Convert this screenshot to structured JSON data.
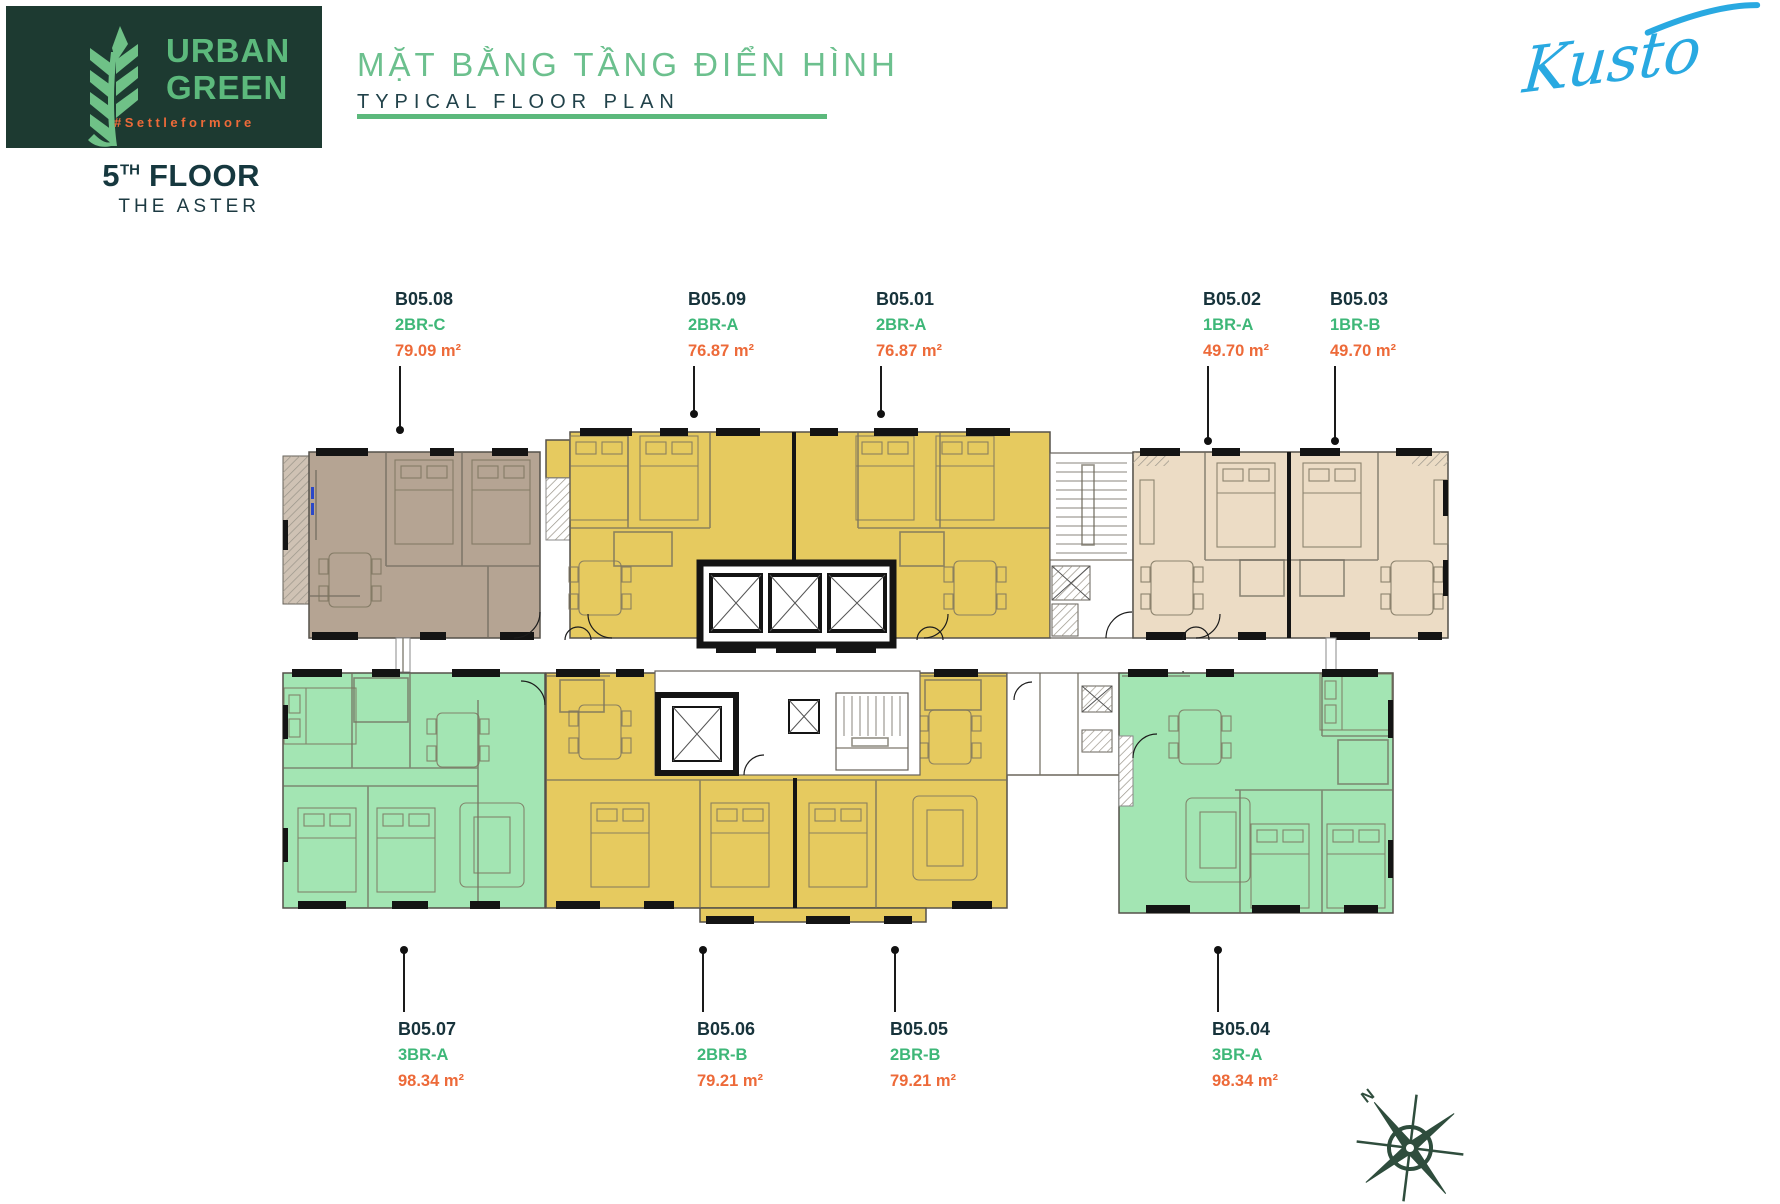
{
  "header": {
    "logo": {
      "line1": "URBAN",
      "line2": "GREEN",
      "hashtag": "#Settleformore"
    },
    "title": {
      "vi": "MẶT BẰNG TẦNG ĐIỂN HÌNH",
      "en": "TYPICAL FLOOR PLAN"
    },
    "brand": "Kusto",
    "floor": {
      "number": "5",
      "ordinal": "TH",
      "word": "FLOOR",
      "building": "THE ASTER"
    }
  },
  "compass": {
    "north_label": "N"
  },
  "colors": {
    "brand_dark": "#1d3a31",
    "brand_green": "#5cb97c",
    "title_green": "#6cc08e",
    "navy": "#17333b",
    "type_green": "#3eb778",
    "orange": "#ed6a39",
    "kusto_blue": "#29a9e1",
    "unit_yellow": "#e6ca5f",
    "unit_green": "#a3e5b3",
    "unit_beige": "#ecdcc5",
    "unit_taupe": "#b5a493",
    "wall_black": "#141414"
  },
  "units": [
    {
      "id": "B05.08",
      "type": "2BR-C",
      "area": "79.09 m²",
      "label_x": 395,
      "label_y": 286,
      "line_x": 399,
      "line_y1": 366,
      "line_y2": 430,
      "dot_y": 430
    },
    {
      "id": "B05.09",
      "type": "2BR-A",
      "area": "76.87 m²",
      "label_x": 688,
      "label_y": 286,
      "line_x": 693,
      "line_y1": 366,
      "line_y2": 414,
      "dot_y": 414
    },
    {
      "id": "B05.01",
      "type": "2BR-A",
      "area": "76.87 m²",
      "label_x": 876,
      "label_y": 286,
      "line_x": 880,
      "line_y1": 366,
      "line_y2": 414,
      "dot_y": 414
    },
    {
      "id": "B05.02",
      "type": "1BR-A",
      "area": "49.70 m²",
      "label_x": 1203,
      "label_y": 286,
      "line_x": 1207,
      "line_y1": 366,
      "line_y2": 441,
      "dot_y": 441
    },
    {
      "id": "B05.03",
      "type": "1BR-B",
      "area": "49.70 m²",
      "label_x": 1330,
      "label_y": 286,
      "line_x": 1334,
      "line_y1": 366,
      "line_y2": 441,
      "dot_y": 441
    },
    {
      "id": "B05.07",
      "type": "3BR-A",
      "area": "98.34 m²",
      "label_x": 398,
      "label_y": 1016,
      "line_x": 403,
      "line_y1": 950,
      "line_y2": 1012,
      "dot_y": 950
    },
    {
      "id": "B05.06",
      "type": "2BR-B",
      "area": "79.21 m²",
      "label_x": 697,
      "label_y": 1016,
      "line_x": 702,
      "line_y1": 950,
      "line_y2": 1012,
      "dot_y": 950
    },
    {
      "id": "B05.05",
      "type": "2BR-B",
      "area": "79.21 m²",
      "label_x": 890,
      "label_y": 1016,
      "line_x": 894,
      "line_y1": 950,
      "line_y2": 1012,
      "dot_y": 950
    },
    {
      "id": "B05.04",
      "type": "3BR-A",
      "area": "98.34 m²",
      "label_x": 1212,
      "label_y": 1016,
      "line_x": 1217,
      "line_y1": 950,
      "line_y2": 1012,
      "dot_y": 950
    }
  ]
}
